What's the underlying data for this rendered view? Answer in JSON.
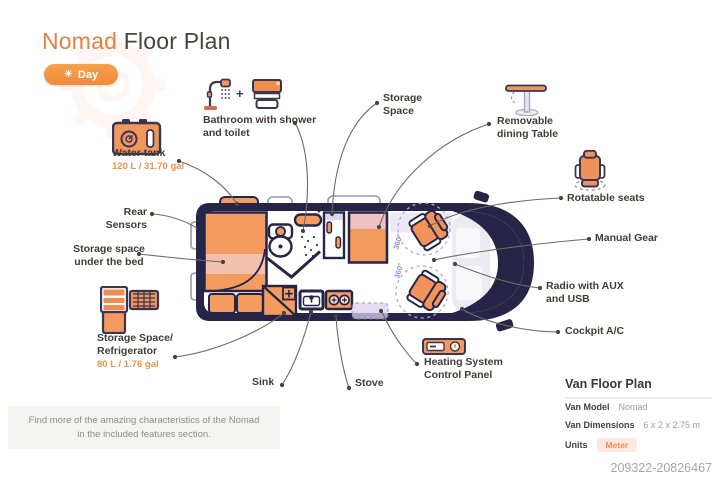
{
  "header": {
    "title_accent": "Nomad",
    "title_rest": " Floor Plan",
    "mode_badge": {
      "label": "Day",
      "sun_icon": "☀"
    }
  },
  "callouts": {
    "bathroom": "Bathroom with shower and toilet",
    "bathroom_plus": "+",
    "water_tank": "Water tank",
    "water_tank_capacity": "120 L / 31.70 gal",
    "rear_sensors": "Rear Sensors",
    "storage_under_bed": "Storage space under the bed",
    "refrigerator": "Storage Space/ Refrigerator",
    "refrigerator_capacity": "80 L / 1.76 gal",
    "sink": "Sink",
    "stove": "Stove",
    "heating": "Heating System Control Panel",
    "storage_space": "Storage Space",
    "dining_table": "Removable dining Table",
    "rotatable_seats": "Rotatable seats",
    "manual_gear": "Manual Gear",
    "radio": "Radio with AUX and USB",
    "cockpit_ac": "Cockpit A/C"
  },
  "van": {
    "seat_rotation_label": "360°"
  },
  "van_info": {
    "title": "Van Floor Plan",
    "model_label": "Van Model",
    "model_value": "Nomad",
    "dimensions_label": "Van Dimensions",
    "dimensions_value": "6 x 2 x 2.75 m",
    "units_label": "Units",
    "units_value": "Meter"
  },
  "footer": {
    "note": "Find more of the amazing characteristics of the Nomad in the included features section.",
    "reference_id": "209322-20826467"
  },
  "colors": {
    "accent_orange": "#EE8640",
    "fill_orange": "#F49B5F",
    "outline_navy": "#262547",
    "band_pink": "#F2C1AE",
    "lavender": "#DCD5EE",
    "capacity_text": "#F0924B"
  },
  "icons": [
    "sun-icon",
    "shower-icon",
    "toilet-icon",
    "water-tank-icon",
    "refrigerator-icon",
    "dining-table-icon",
    "rotatable-seat-icon",
    "heating-panel-icon"
  ]
}
